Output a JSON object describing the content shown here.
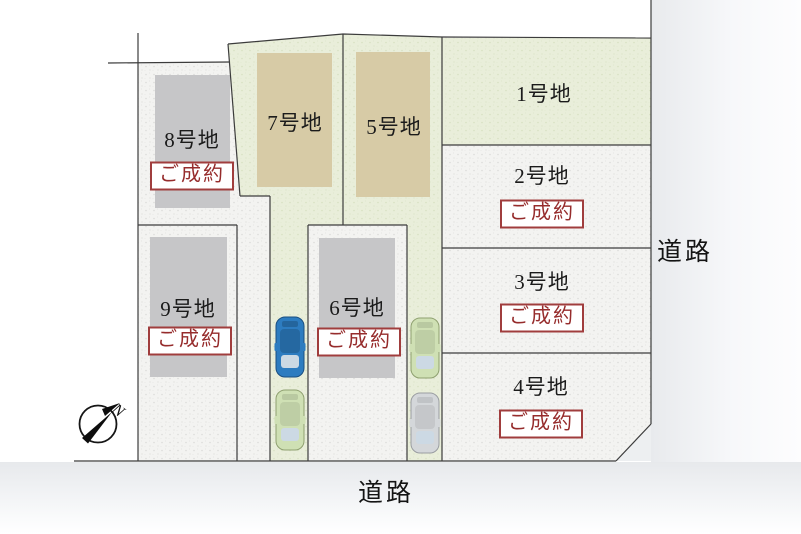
{
  "title": "分譲地区画図",
  "roads": {
    "right_label": "道路",
    "bottom_label": "道路"
  },
  "compass": {
    "north_label": "N"
  },
  "lots": [
    {
      "label": "1号地",
      "status": ""
    },
    {
      "label": "2号地",
      "status": "ご成約"
    },
    {
      "label": "3号地",
      "status": "ご成約"
    },
    {
      "label": "4号地",
      "status": "ご成約"
    },
    {
      "label": "5号地",
      "status": ""
    },
    {
      "label": "6号地",
      "status": "ご成約"
    },
    {
      "label": "7号地",
      "status": ""
    },
    {
      "label": "8号地",
      "status": "ご成約"
    },
    {
      "label": "9号地",
      "status": "ご成約"
    }
  ],
  "colors": {
    "sold_text": "#962c2c",
    "sold_border": "#a03d3d",
    "parcel_white": "#f3f3f1",
    "parcel_green": "#e9eeda",
    "building_gray": "#c6c6c8",
    "building_tan": "#d7cba6",
    "car_blue": "#2d7cc0",
    "car_green": "#cfe0b4",
    "car_silver": "#d4d7da",
    "windshield": "#ccd9e4",
    "line": "#3c3c3c",
    "road_gray": "#e8eaed"
  }
}
